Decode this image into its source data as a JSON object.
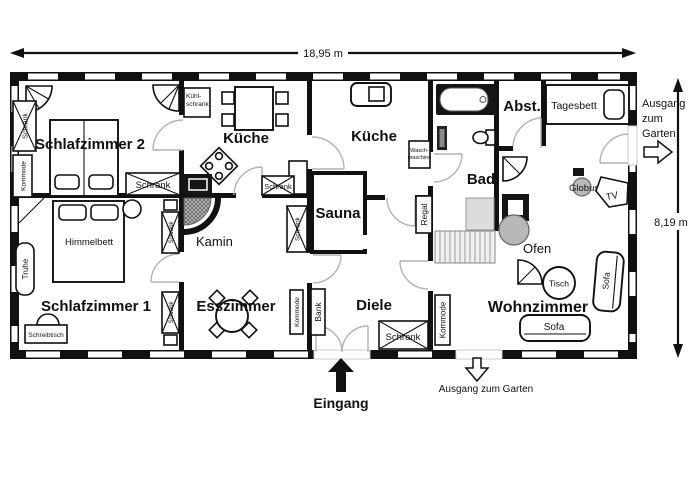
{
  "dimensions": {
    "width": "18,95 m",
    "height": "8,19 m"
  },
  "rooms": {
    "schlafzimmer2": "Schlafzimmer 2",
    "kueche_links": "Küche",
    "kueche_rechts": "Küche",
    "sauna": "Sauna",
    "bad": "Bad",
    "abstellraum": "Abst.",
    "schlafzimmer1": "Schlafzimmer 1",
    "esszimmer": "Esszimmer",
    "diele": "Diele",
    "wohnzimmer": "Wohnzimmer"
  },
  "furniture": {
    "schrank": "Schrank",
    "kommode": "Kommode",
    "bank": "Bank",
    "regal": "Regal",
    "truhe": "Truhe",
    "schreibtisch": "Schreibtisch",
    "himmelbett": "Himmelbett",
    "tagesbett": "Tagesbett",
    "kamin": "Kamin",
    "ofen": "Ofen",
    "tisch": "Tisch",
    "sofa": "Sofa",
    "globus": "Globus",
    "tv": "TV",
    "kuehlschrank_l1": "Kühl-",
    "kuehlschrank_l2": "schrank",
    "waschmaschine_l1": "Wasch-",
    "waschmaschine_l2": "maschine"
  },
  "annotations": {
    "eingang": "Eingang",
    "ausgang_garten": "Ausgang zum Garten",
    "ausgang_r1": "Ausgang",
    "ausgang_r2": "zum",
    "ausgang_r3": "Garten"
  },
  "colors": {
    "wall": "#111111",
    "door_arc": "#b3b3b3",
    "gray_fill": "#b8b8b8",
    "background": "#ffffff"
  }
}
